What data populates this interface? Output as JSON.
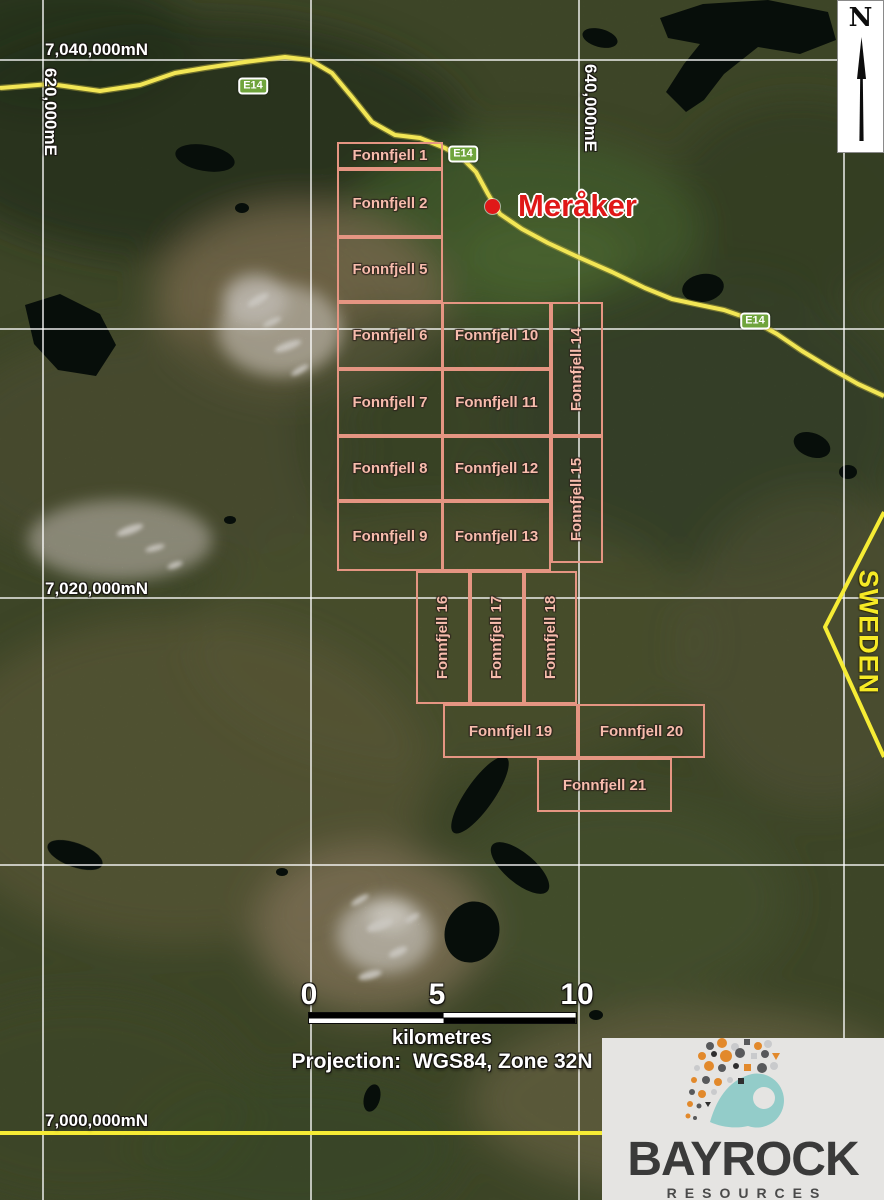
{
  "map": {
    "town": {
      "name": "Meråker",
      "x": 518,
      "y": 188,
      "dot_x": 492,
      "dot_y": 206
    },
    "road": {
      "name": "E14",
      "badges": [
        {
          "x": 253,
          "y": 86
        },
        {
          "x": 463,
          "y": 154
        },
        {
          "x": 755,
          "y": 321
        }
      ]
    },
    "neighbor_country": {
      "label": "SWEDEN",
      "x": 868,
      "y": 632
    },
    "graticule": {
      "northing_labels": [
        {
          "text": "7,040,000mN",
          "x": 45,
          "y": 40
        },
        {
          "text": "7,020,000mN",
          "x": 45,
          "y": 579
        },
        {
          "text": "7,000,000mN",
          "x": 45,
          "y": 1111
        }
      ],
      "easting_labels": [
        {
          "text": "620,000mE",
          "x": 50,
          "y": 112
        },
        {
          "text": "640,000mE",
          "x": 590,
          "y": 108
        }
      ]
    },
    "licenses": [
      {
        "label": "Fonnfjell 1",
        "x": 337,
        "y": 142,
        "w": 106,
        "h": 27
      },
      {
        "label": "Fonnfjell 2",
        "x": 337,
        "y": 169,
        "w": 106,
        "h": 68
      },
      {
        "label": "Fonnfjell 5",
        "x": 337,
        "y": 237,
        "w": 106,
        "h": 65
      },
      {
        "label": "Fonnfjell 6",
        "x": 337,
        "y": 302,
        "w": 106,
        "h": 67
      },
      {
        "label": "Fonnfjell 7",
        "x": 337,
        "y": 369,
        "w": 106,
        "h": 67
      },
      {
        "label": "Fonnfjell 8",
        "x": 337,
        "y": 436,
        "w": 106,
        "h": 65
      },
      {
        "label": "Fonnfjell 9",
        "x": 337,
        "y": 501,
        "w": 106,
        "h": 70
      },
      {
        "label": "Fonnfjell 10",
        "x": 442,
        "y": 302,
        "w": 109,
        "h": 67
      },
      {
        "label": "Fonnfjell 11",
        "x": 442,
        "y": 369,
        "w": 109,
        "h": 67
      },
      {
        "label": "Fonnfjell 12",
        "x": 442,
        "y": 436,
        "w": 109,
        "h": 65
      },
      {
        "label": "Fonnfjell 13",
        "x": 442,
        "y": 501,
        "w": 109,
        "h": 70
      },
      {
        "label": "Fonnfjell 14",
        "x": 551,
        "y": 302,
        "w": 52,
        "h": 134,
        "v": true
      },
      {
        "label": "Fonnfjell 15",
        "x": 551,
        "y": 436,
        "w": 52,
        "h": 127,
        "v": true
      },
      {
        "label": "Fonnfjell 16",
        "x": 416,
        "y": 571,
        "w": 54,
        "h": 133,
        "v": true
      },
      {
        "label": "Fonnfjell 17",
        "x": 470,
        "y": 571,
        "w": 54,
        "h": 133,
        "v": true
      },
      {
        "label": "Fonnfjell 18",
        "x": 524,
        "y": 571,
        "w": 53,
        "h": 133,
        "v": true
      },
      {
        "label": "Fonnfjell 19",
        "x": 443,
        "y": 704,
        "w": 135,
        "h": 54
      },
      {
        "label": "Fonnfjell 20",
        "x": 578,
        "y": 704,
        "w": 127,
        "h": 54
      },
      {
        "label": "Fonnfjell 21",
        "x": 537,
        "y": 758,
        "w": 135,
        "h": 54
      }
    ],
    "north_arrow": {
      "label": "N"
    },
    "scale_bar": {
      "ticks": [
        {
          "label": "0",
          "x": 309
        },
        {
          "label": "5",
          "x": 437
        },
        {
          "label": "10",
          "x": 577
        }
      ],
      "unit": "kilometres",
      "projection": "Projection:  WGS84, Zone 32N"
    },
    "logo": {
      "name": "BAYROCK",
      "subtitle": "RESOURCES"
    },
    "colors": {
      "license_outline": "#e59582",
      "license_text": "#f7bcac",
      "road": "#f2e655",
      "road_badge": "#6fa43c",
      "town_text": "#e01818",
      "border_yellow": "#f6ec35",
      "sweden_text": "#f6ea25"
    }
  }
}
